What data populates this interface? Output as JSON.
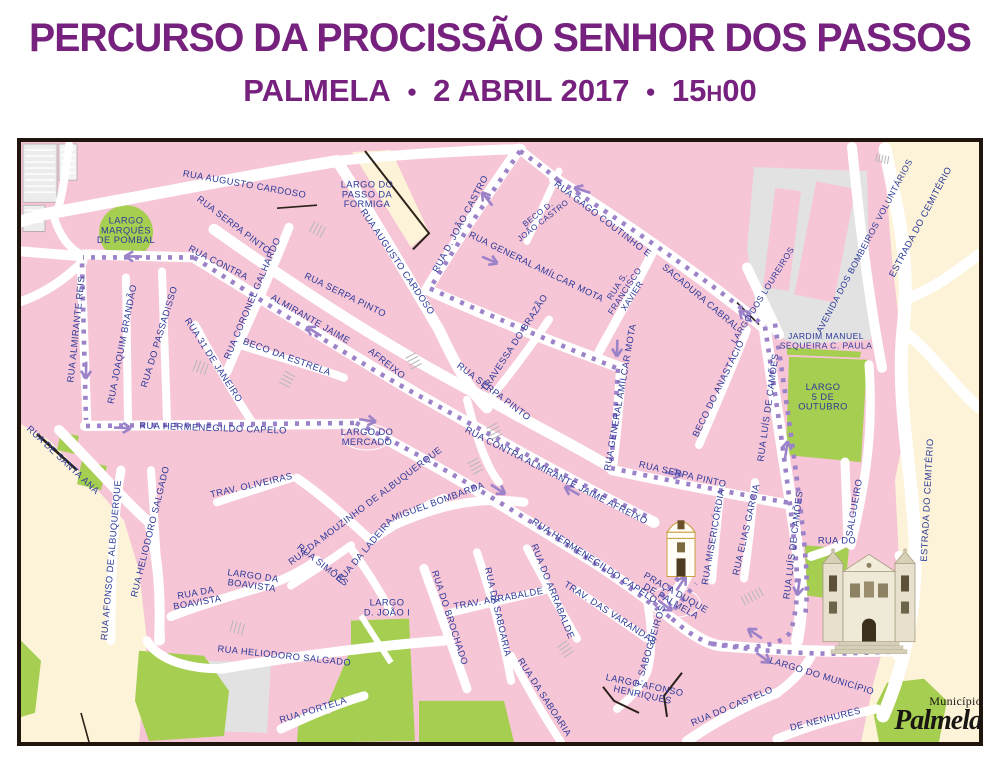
{
  "header": {
    "title": "PERCURSO DA PROCISSÃO SENHOR DOS PASSOS",
    "city": "PALMELA",
    "date": "2 ABRIL 2017",
    "time_hours": "15",
    "time_sep": "H",
    "time_minutes": "00",
    "bullet": "●"
  },
  "map": {
    "colors": {
      "title_purple": "#76217e",
      "building_pink": "#f6c5d6",
      "park_green": "#a6ce51",
      "outskirts_beige": "#fcf3d8",
      "street_white": "#ffffff",
      "label_blue": "#2b3a99",
      "route_purple": "#9c82c8",
      "frame_black": "#20150d"
    },
    "route": {
      "style": "dotted",
      "color": "#9c82c8",
      "arrows": [
        [
          580,
          190,
          198
        ],
        [
          486,
          197,
          232
        ],
        [
          494,
          262,
          23
        ],
        [
          618,
          352,
          92
        ],
        [
          744,
          314,
          223
        ],
        [
          678,
          474,
          8
        ],
        [
          788,
          446,
          -81
        ],
        [
          799,
          590,
          99
        ],
        [
          131,
          257,
          181
        ],
        [
          87,
          374,
          91
        ],
        [
          127,
          428,
          2
        ],
        [
          372,
          421,
          8
        ],
        [
          502,
          491,
          33
        ],
        [
          312,
          330,
          211
        ],
        [
          570,
          489,
          209
        ],
        [
          684,
          580,
          -57
        ],
        [
          669,
          607,
          36
        ],
        [
          753,
          631,
          214
        ],
        [
          767,
          659,
          36
        ],
        [
          901,
          632,
          -66
        ],
        [
          854,
          644,
          187
        ]
      ]
    },
    "labels": [
      {
        "t": "RUA AUGUSTO CARDOSO",
        "x": 245,
        "y": 188,
        "r": 10
      },
      {
        "lines": [
          "LARGO DO",
          "PASSO DA",
          "FORMIGA"
        ],
        "x": 368,
        "y": 198,
        "r": 0
      },
      {
        "lines": [
          "LARGO",
          "MARQUÊS",
          "DE POMBAL"
        ],
        "x": 127,
        "y": 234,
        "r": 0
      },
      {
        "t": "RUA D. JOÃO CASTRO",
        "x": 464,
        "y": 226,
        "r": -62
      },
      {
        "lines": [
          "BECO D.",
          "JOÃO CASTRO"
        ],
        "x": 543,
        "y": 220,
        "r": -38,
        "s": 8
      },
      {
        "t": "RUA GAGO COUTINHO E",
        "x": 602,
        "y": 222,
        "r": 37
      },
      {
        "t": "SACADURA CABRAL",
        "x": 700,
        "y": 300,
        "r": 40
      },
      {
        "lines": [
          "RUA S.",
          "FRANCISCO",
          "XAVIER"
        ],
        "x": 628,
        "y": 293,
        "r": -57,
        "s": 8.5
      },
      {
        "t": "RUA SERPA PINTO",
        "x": 233,
        "y": 228,
        "r": 37
      },
      {
        "t": "RUA CONTRA",
        "x": 218,
        "y": 266,
        "r": 27
      },
      {
        "t": "ALMIRANTE JAIME",
        "x": 310,
        "y": 322,
        "r": 30
      },
      {
        "t": "AFREIXO",
        "x": 386,
        "y": 366,
        "r": 38
      },
      {
        "t": "RUA CORONEL GALHARDO",
        "x": 256,
        "y": 300,
        "r": -67
      },
      {
        "t": "RUA AUGUSTO CARDOSO",
        "x": 396,
        "y": 264,
        "r": 56
      },
      {
        "t": "RUA SERPA PINTO",
        "x": 345,
        "y": 298,
        "r": 26
      },
      {
        "t": "TRAVESSA DO BRAZÃO",
        "x": 518,
        "y": 345,
        "r": -57
      },
      {
        "t": "RUA GENERAL AMÍLCAR MOTA",
        "x": 536,
        "y": 270,
        "r": 26
      },
      {
        "t": "RUA GENERAL AMÍLCAR MOTA",
        "x": 624,
        "y": 398,
        "r": -80
      },
      {
        "t": "BECO DO ANASTÁCIO",
        "x": 722,
        "y": 390,
        "r": -64
      },
      {
        "t": "LARGO DOS LOUREIROS",
        "x": 766,
        "y": 297,
        "r": -58,
        "s": 8.5
      },
      {
        "t": "AVENIDA DOS BOMBEIROS VOLUNTÁRIOS",
        "x": 868,
        "y": 248,
        "r": -62,
        "s": 8.8
      },
      {
        "t": "ESTRADA DO CEMITÉRIO",
        "x": 924,
        "y": 224,
        "r": -62
      },
      {
        "lines": [
          "JARDIM MANUEL",
          "SEQUEIRA C. PAULA"
        ],
        "x": 827,
        "y": 344,
        "r": 0,
        "s": 8.6
      },
      {
        "lines": [
          "LARGO",
          "5 DE",
          "OUTUBRO"
        ],
        "x": 824,
        "y": 400,
        "r": 0
      },
      {
        "t": "RUA ALMIRANTE REIS",
        "x": 80,
        "y": 330,
        "r": -84
      },
      {
        "t": "RUA JOAQUIM BRANDÃO",
        "x": 126,
        "y": 345,
        "r": -79
      },
      {
        "t": "RUA DO PASSADISSO",
        "x": 163,
        "y": 338,
        "r": -73
      },
      {
        "t": "RUA 31 DE JANEIRO",
        "x": 212,
        "y": 362,
        "r": 57
      },
      {
        "t": "BECO DA ESTRELA",
        "x": 287,
        "y": 360,
        "r": 20
      },
      {
        "t": "RUA SERPA PINTO",
        "x": 493,
        "y": 394,
        "r": 37
      },
      {
        "t": "RUA HERMENEGILDO CAPELO",
        "x": 214,
        "y": 431,
        "r": 2
      },
      {
        "lines": [
          "LARGO DO",
          "MERCADO"
        ],
        "x": 368,
        "y": 440,
        "r": 0
      },
      {
        "t": "RUA DE SANTA ANA",
        "x": 62,
        "y": 462,
        "r": 43
      },
      {
        "t": "RUA AFONSO DE ALBUQUERQUE",
        "x": 115,
        "y": 560,
        "r": -85
      },
      {
        "t": "RUA HELIODORO SALGADO",
        "x": 154,
        "y": 532,
        "r": -76
      },
      {
        "t": "TRAV. OLIVEIRAS",
        "x": 253,
        "y": 488,
        "r": -13
      },
      {
        "t": "RUA DA MOUZINHO DE ALBUQUERQUE",
        "x": 368,
        "y": 508,
        "r": -37
      },
      {
        "t": "MIGUEL BOMBARDA",
        "x": 440,
        "y": 504,
        "r": -20
      },
      {
        "t": "RUA CONTRA ALMIRANTE JAIME AFREIXO",
        "x": 556,
        "y": 478,
        "r": 27
      },
      {
        "t": "RUA SERPA PINTO",
        "x": 683,
        "y": 477,
        "r": 13
      },
      {
        "t": "RUA HERMENEGILDO CAPELO",
        "x": 594,
        "y": 563,
        "r": 33
      },
      {
        "t": "RUA DA LADEIRA",
        "x": 368,
        "y": 552,
        "r": -50
      },
      {
        "t": "RUA SIMÕES",
        "x": 322,
        "y": 567,
        "r": 38
      },
      {
        "lines": [
          "LARGO DA",
          "BOAVISTA"
        ],
        "x": 253,
        "y": 583,
        "r": 8
      },
      {
        "lines": [
          "RUA DA",
          "BOAVISTA"
        ],
        "x": 198,
        "y": 600,
        "r": -10
      },
      {
        "t": "RUA HELIODORO SALGADO",
        "x": 285,
        "y": 658,
        "r": 6
      },
      {
        "t": "RUA PORTELA",
        "x": 315,
        "y": 712,
        "r": -17
      },
      {
        "lines": [
          "LARGO",
          "D. JOÃO I"
        ],
        "x": 388,
        "y": 610,
        "r": 0
      },
      {
        "t": "RUA DO BROCHADO",
        "x": 448,
        "y": 618,
        "r": 72
      },
      {
        "t": "TRAV. ARRABALDE",
        "x": 500,
        "y": 601,
        "r": -10
      },
      {
        "t": "RUA DA SABOARIA",
        "x": 496,
        "y": 612,
        "r": 77
      },
      {
        "t": "RUA DA SABOARIA",
        "x": 543,
        "y": 698,
        "r": 57
      },
      {
        "t": "RUA DO ARRABALDE",
        "x": 551,
        "y": 592,
        "r": 68
      },
      {
        "t": "TRAV. DAS VARANDAS",
        "x": 610,
        "y": 615,
        "r": 33
      },
      {
        "t": "T. SABOGUEIROS",
        "x": 654,
        "y": 646,
        "r": -73
      },
      {
        "lines": [
          "LARGO AFONSO",
          "HENRIQUES"
        ],
        "x": 644,
        "y": 692,
        "r": 12
      },
      {
        "t": "RUA DO CASTELO",
        "x": 734,
        "y": 708,
        "r": -23
      },
      {
        "t": "LARGO DO MUNICÍPIO",
        "x": 822,
        "y": 678,
        "r": 17
      },
      {
        "t": "DE NENHURES",
        "x": 827,
        "y": 721,
        "r": -14
      },
      {
        "t": "SALGUEIRO",
        "x": 858,
        "y": 508,
        "r": -80
      },
      {
        "t": "RUA DO",
        "x": 838,
        "y": 543,
        "r": 0
      },
      {
        "t": "ESTRADA DO CEMITÉRIO",
        "x": 931,
        "y": 500,
        "r": -87
      },
      {
        "t": "RUA MISERICÓRDIA",
        "x": 717,
        "y": 537,
        "r": -80
      },
      {
        "t": "RUA ELIAS GARCIA",
        "x": 750,
        "y": 530,
        "r": -77
      },
      {
        "t": "RUA LUÍS DE CAMÕES",
        "x": 772,
        "y": 408,
        "r": -82
      },
      {
        "t": "RUA LUÍS DE CAMÕES",
        "x": 797,
        "y": 545,
        "r": -83
      },
      {
        "lines": [
          "PRAÇA DUQUE",
          "DE PALMELA"
        ],
        "x": 673,
        "y": 599,
        "r": 30
      }
    ],
    "landmarks": {
      "small_church": "church-icon",
      "large_church": "church-icon"
    },
    "logo": {
      "line1": "Município",
      "line2": "Palmela"
    }
  }
}
